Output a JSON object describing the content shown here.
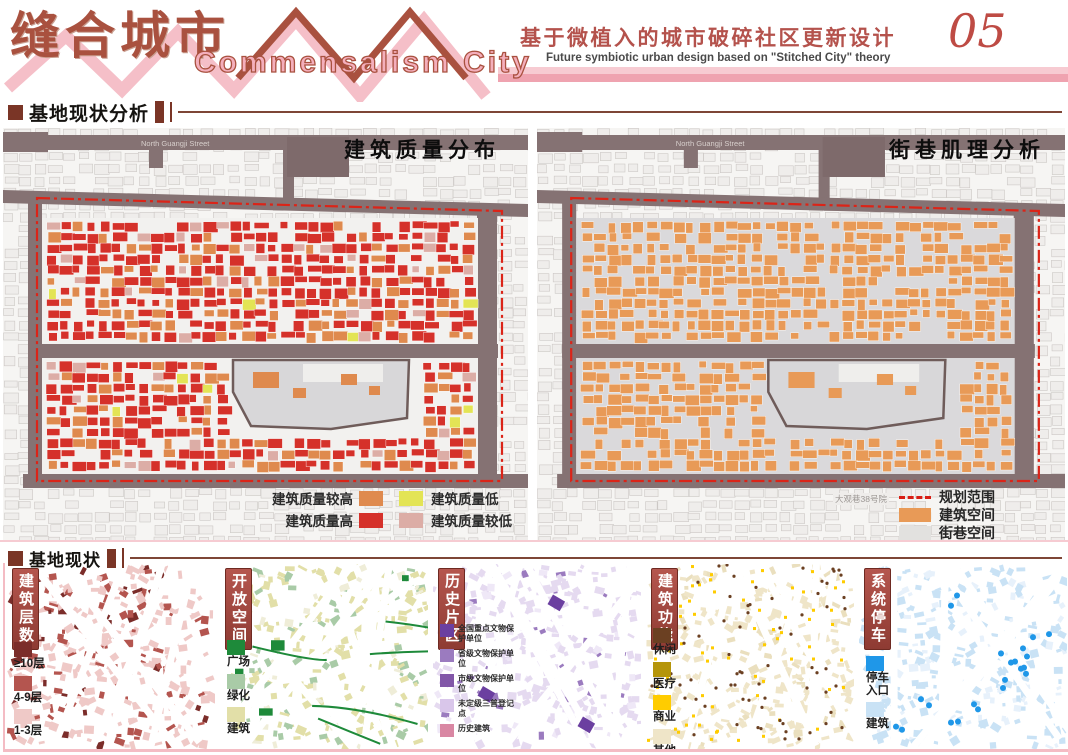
{
  "header": {
    "title_cn": "缝合城市",
    "title_en": "Commensalism City",
    "subtitle_cn": "基于微植入的城市破碎社区更新设计",
    "subtitle_en": "Future symbiotic urban design based on \"Stitched City\" theory",
    "page_number": "05"
  },
  "sections": [
    {
      "title": "基地现状分析"
    },
    {
      "title": "基地现状"
    }
  ],
  "colors": {
    "accent_pink": "#F4BCC4",
    "accent_dark_red": "#A9513F",
    "road": "#857273",
    "planning_boundary": "#DB2418"
  },
  "big_maps": [
    {
      "id": "building-quality",
      "title": "建筑质量分布",
      "street_label": "North Guangji Street",
      "legend": [
        {
          "label": "建筑质量较高",
          "color": "#DF8A4E"
        },
        {
          "label": "建筑质量低",
          "color": "#E3E455"
        },
        {
          "label": "建筑质量高",
          "color": "#D5312A"
        },
        {
          "label": "建筑质量较低",
          "color": "#DCADA6"
        }
      ]
    },
    {
      "id": "street-texture",
      "title": "街巷肌理分析",
      "street_label": "North Guangji Street",
      "map_note": "大观巷38号院",
      "legend": [
        {
          "label": "规划范围",
          "color": "#D81E14",
          "type": "dashed-line"
        },
        {
          "label": "建筑空间",
          "color": "#E89A57",
          "type": "swatch"
        },
        {
          "label": "街巷空间",
          "color": "#E2E1DF",
          "type": "swatch"
        }
      ]
    }
  ],
  "small_maps": [
    {
      "tag": "建筑层数",
      "legend": [
        {
          "label": "≥10层",
          "color": "#7B2D2A"
        },
        {
          "label": "4-9层",
          "color": "#B4554F"
        },
        {
          "label": "1-3层",
          "color": "#EFC9C7"
        }
      ]
    },
    {
      "tag": "开放空间",
      "legend": [
        {
          "label": "广场",
          "color": "#1E8A3A"
        },
        {
          "label": "绿化",
          "color": "#A9CBA7"
        },
        {
          "label": "建筑",
          "color": "#E2DFA8"
        }
      ]
    },
    {
      "tag": "历史片区",
      "legend": [
        {
          "label": "全国重点文物保护单位",
          "color": "#6B3FA0"
        },
        {
          "label": "省级文物保护单位",
          "color": "#9B7BBF"
        },
        {
          "label": "市级文物保护单位",
          "color": "#8257A8"
        },
        {
          "label": "未定级三普登记点",
          "color": "#D9C6EA"
        },
        {
          "label": "历史建筑",
          "color": "#D987A3"
        }
      ]
    },
    {
      "tag": "建筑功能",
      "legend": [
        {
          "label": "休闲",
          "color": "#6B4022"
        },
        {
          "label": "医疗",
          "color": "#B5950A"
        },
        {
          "label": "商业",
          "color": "#FFCC00"
        },
        {
          "label": "其他",
          "color": "#EFE5C8"
        }
      ]
    },
    {
      "tag": "系统停车",
      "legend": [
        {
          "label": "停车入口",
          "color": "#1F97E8"
        },
        {
          "label": "建筑",
          "color": "#C9E2F5"
        }
      ]
    }
  ]
}
